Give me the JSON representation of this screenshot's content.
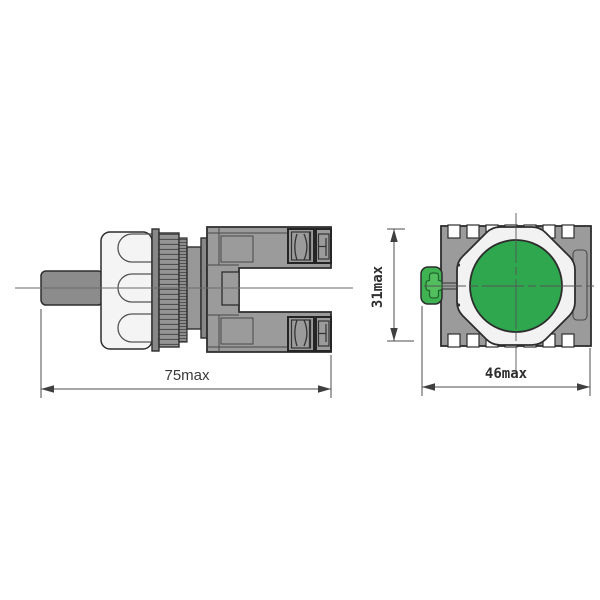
{
  "drawing": {
    "title": "push-button switch dimensional drawing",
    "views": {
      "side_view": {
        "name": "side view",
        "length_dimension": {
          "label": "75max"
        }
      },
      "front_view": {
        "name": "front view",
        "width_dimension": {
          "label": "46max"
        },
        "height_dimension": {
          "label": "31max"
        }
      }
    }
  },
  "colors": {
    "button_green": "#2EA74E",
    "actuator_green": "#3FB351",
    "cross_detail_green": "#52BE5E",
    "body_gray": "#9B9B9B",
    "shaft_gray": "#8C8C8C",
    "knob_white": "#F4F4F4",
    "outline": "#2D2D2D",
    "dimension_line": "#4C4C4C"
  }
}
